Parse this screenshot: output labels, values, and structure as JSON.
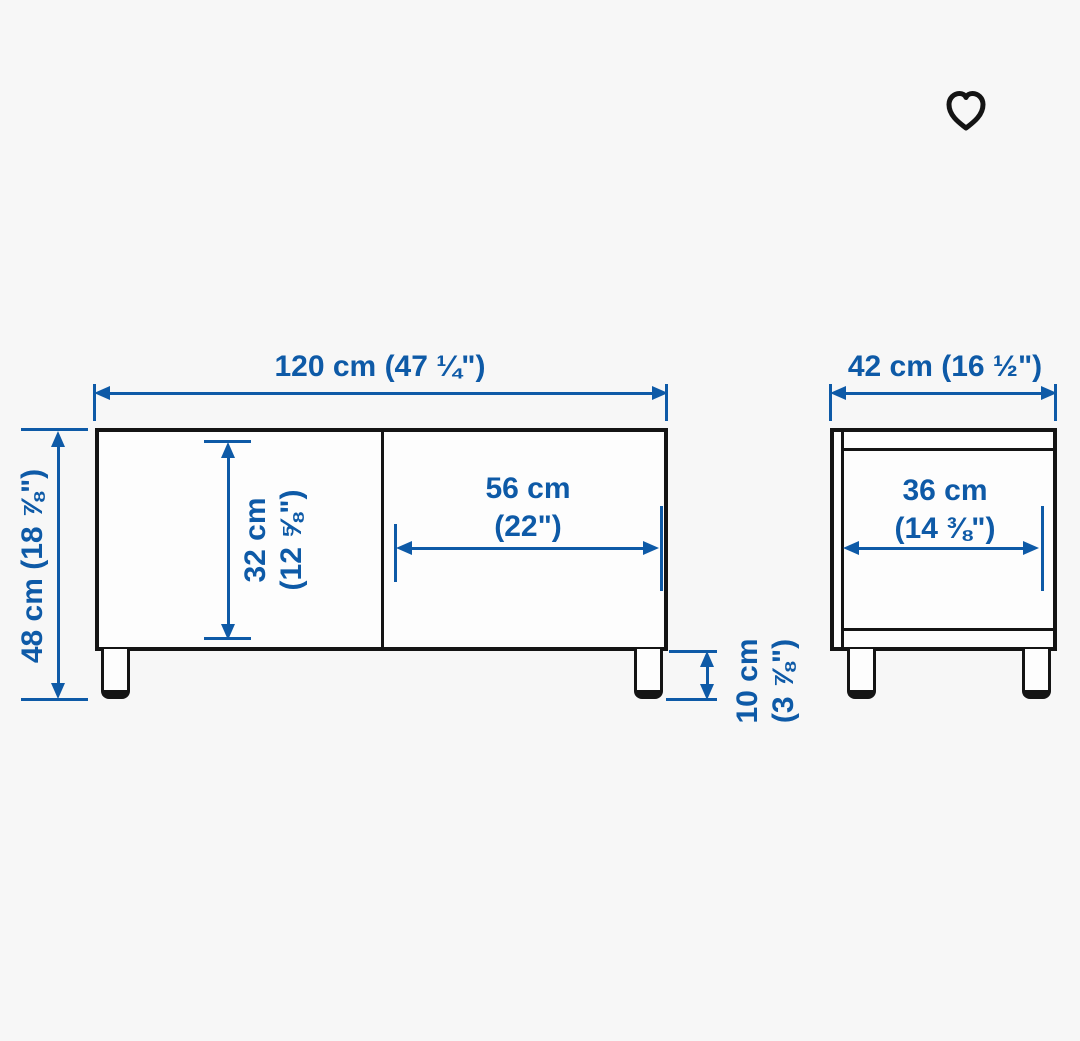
{
  "colors": {
    "dimension_blue": "#0e5aa7",
    "outline_dark": "#141414",
    "page_bg": "#f7f7f7"
  },
  "header": {
    "favorite_icon": "heart-outline"
  },
  "front_view": {
    "width_label": "120 cm (47 ¼\")",
    "height_label": "48 cm (18 ⅞\")",
    "inner_height_cm": "32 cm",
    "inner_height_in": "(12 ⅝\")",
    "inner_width_cm": "56 cm",
    "inner_width_in": "(22\")",
    "leg_height_cm": "10 cm",
    "leg_height_in": "(3 ⅞\")"
  },
  "side_view": {
    "depth_label": "42 cm (16 ½\")",
    "inner_depth_cm": "36 cm",
    "inner_depth_in": "(14 ⅜\")"
  }
}
